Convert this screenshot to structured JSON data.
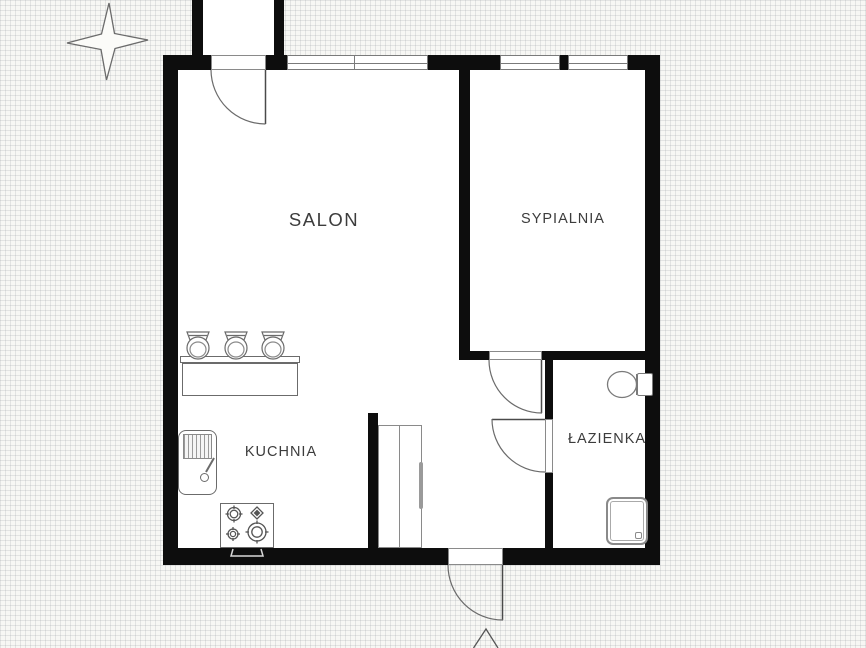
{
  "rooms": [
    {
      "id": "salon",
      "label": "SALON"
    },
    {
      "id": "sypialnia",
      "label": "SYPIALNIA"
    },
    {
      "id": "kuchnia",
      "label": "KUCHNIA"
    },
    {
      "id": "lazienka",
      "label": "ŁAZIENKA"
    }
  ],
  "icons": {
    "compass": "four-point-star",
    "entrance_marker": "triangle-up-arrow"
  },
  "fixtures": [
    "entrance-door-top",
    "entrance-door-bottom",
    "bedroom-door",
    "bathroom-door",
    "kitchen-counter",
    "bar-stool",
    "bar-stool",
    "bar-stool",
    "kitchen-sink",
    "gas-stove",
    "wardrobe",
    "toilet",
    "shower-tray"
  ],
  "colors": {
    "wall": "#0d0d0d",
    "outline": "#6b6b6b",
    "text": "#3c3c3c",
    "paper": "#f7f7f4",
    "interior": "#ffffff"
  }
}
